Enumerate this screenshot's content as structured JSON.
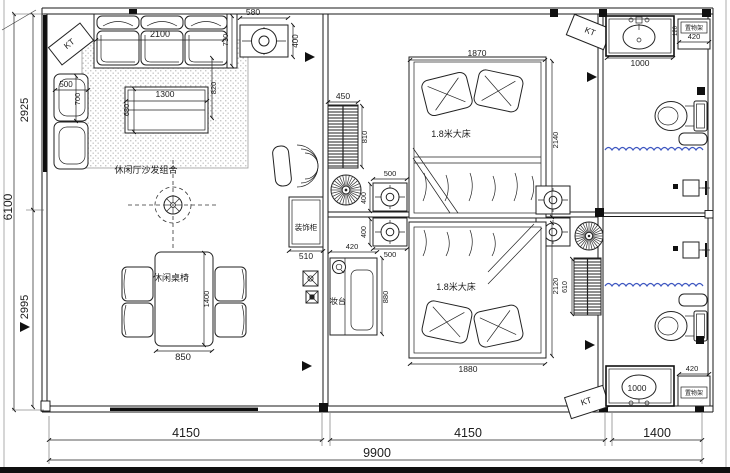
{
  "drawing": {
    "type": "residential floor plan",
    "overall_width_mm": "9900",
    "overall_height_mm": "6100",
    "room_labels": {
      "living_sofa_set": "休闲厅沙发组合",
      "leisure_table_chairs": "休闲桌椅",
      "decorative_cabinet": "装饰柜",
      "dressing_table": "妆台",
      "double_bed": "1.8米大床",
      "shelf_rack": "置物架",
      "air_conditioner": "KT"
    },
    "fixtures": [
      "ceiling-fan",
      "air-conditioner-unit",
      "ac-cassette",
      "radiator-grille",
      "bed",
      "sofa",
      "armchair",
      "coffee-table",
      "dining-table",
      "dining-chair",
      "desk-chair",
      "dressing-table",
      "decorative-cabinet",
      "vanity-sink",
      "toilet",
      "bath-mat",
      "shelf-rack",
      "shower-head",
      "shower-curtain",
      "wall-switch",
      "hairdryer"
    ]
  },
  "colors": {
    "line": "#1a1a1a",
    "water": "#3d56c0",
    "background": "#ffffff"
  },
  "labels": [
    {
      "text": "580",
      "x": 253,
      "y": 15,
      "rot": 0,
      "size": 8.5
    },
    {
      "text": "400",
      "x": 298,
      "y": 41,
      "rot": -90,
      "size": 8
    },
    {
      "text": "2100",
      "x": 160,
      "y": 37,
      "rot": 0,
      "size": 9
    },
    {
      "text": "730",
      "x": 228,
      "y": 40,
      "rot": -90,
      "size": 7.5
    },
    {
      "text": "820",
      "x": 216,
      "y": 88,
      "rot": -90,
      "size": 7.5
    },
    {
      "text": "KT",
      "x": 71,
      "y": 46,
      "rot": -38,
      "size": 8.5
    },
    {
      "text": "500",
      "x": 66,
      "y": 87,
      "rot": 0,
      "size": 8
    },
    {
      "text": "700",
      "x": 80,
      "y": 99,
      "rot": -90,
      "size": 7.5
    },
    {
      "text": "1300",
      "x": 165,
      "y": 97,
      "rot": 0,
      "size": 8.5
    },
    {
      "text": "680",
      "x": 129,
      "y": 110,
      "rot": -90,
      "size": 7.5
    },
    {
      "text": "休闲厅沙发组合",
      "x": 146,
      "y": 173,
      "rot": 0,
      "size": 9
    },
    {
      "text": "休闲桌椅",
      "x": 171,
      "y": 281,
      "rot": 0,
      "size": 9
    },
    {
      "text": "1400",
      "x": 209,
      "y": 299,
      "rot": -90,
      "size": 7.5
    },
    {
      "text": "850",
      "x": 183,
      "y": 360,
      "rot": 0,
      "size": 9.5
    },
    {
      "text": "装饰柜",
      "x": 306,
      "y": 230,
      "rot": 0,
      "size": 7.5
    },
    {
      "text": "510",
      "x": 306,
      "y": 259,
      "rot": 0,
      "size": 8.5
    },
    {
      "text": "2925",
      "x": 28,
      "y": 110,
      "rot": -90,
      "size": 11
    },
    {
      "text": "6100",
      "x": 12,
      "y": 207,
      "rot": -90,
      "size": 12
    },
    {
      "text": "2995",
      "x": 28,
      "y": 307,
      "rot": -90,
      "size": 11
    },
    {
      "text": "450",
      "x": 343,
      "y": 99,
      "rot": 0,
      "size": 8.5
    },
    {
      "text": "810",
      "x": 367,
      "y": 137,
      "rot": -90,
      "size": 7.5
    },
    {
      "text": "1870",
      "x": 477,
      "y": 56,
      "rot": 0,
      "size": 8.5
    },
    {
      "text": "1.8米大床",
      "x": 451,
      "y": 137,
      "rot": 0,
      "size": 9
    },
    {
      "text": "2140",
      "x": 558,
      "y": 140,
      "rot": -90,
      "size": 7.5
    },
    {
      "text": "500",
      "x": 390,
      "y": 176,
      "rot": 0,
      "size": 7.5
    },
    {
      "text": "400",
      "x": 366,
      "y": 198,
      "rot": -90,
      "size": 7
    },
    {
      "text": "500",
      "x": 390,
      "y": 257,
      "rot": 0,
      "size": 7.5
    },
    {
      "text": "400",
      "x": 366,
      "y": 232,
      "rot": -90,
      "size": 7
    },
    {
      "text": "KT",
      "x": 589,
      "y": 34,
      "rot": 22,
      "size": 8.5
    },
    {
      "text": "420",
      "x": 352,
      "y": 249,
      "rot": 0,
      "size": 7.5
    },
    {
      "text": "妆台",
      "x": 338,
      "y": 304,
      "rot": 0,
      "size": 8
    },
    {
      "text": "880",
      "x": 388,
      "y": 297,
      "rot": -90,
      "size": 7.5
    },
    {
      "text": "1.8米大床",
      "x": 456,
      "y": 290,
      "rot": 0,
      "size": 9
    },
    {
      "text": "1880",
      "x": 468,
      "y": 372,
      "rot": 0,
      "size": 8.5
    },
    {
      "text": "2120",
      "x": 558,
      "y": 286,
      "rot": -90,
      "size": 7.5
    },
    {
      "text": "610",
      "x": 567,
      "y": 287,
      "rot": -90,
      "size": 7
    },
    {
      "text": "KT",
      "x": 587,
      "y": 404,
      "rot": -18,
      "size": 8.5
    },
    {
      "text": "1000",
      "x": 640,
      "y": 66,
      "rot": 0,
      "size": 8.5
    },
    {
      "text": "置物架",
      "x": 694,
      "y": 30,
      "rot": 0,
      "size": 6
    },
    {
      "text": "420",
      "x": 694,
      "y": 39,
      "rot": 0,
      "size": 7.5
    },
    {
      "text": "120",
      "x": 677,
      "y": 31,
      "rot": -90,
      "size": 6
    },
    {
      "text": "420",
      "x": 692,
      "y": 371,
      "rot": 0,
      "size": 7.5
    },
    {
      "text": "1000",
      "x": 637,
      "y": 391,
      "rot": 0,
      "size": 8.5
    },
    {
      "text": "置物架",
      "x": 694,
      "y": 395,
      "rot": 0,
      "size": 6
    },
    {
      "text": "4150",
      "x": 186,
      "y": 437,
      "rot": 0,
      "size": 12.5
    },
    {
      "text": "4150",
      "x": 468,
      "y": 437,
      "rot": 0,
      "size": 12.5
    },
    {
      "text": "1400",
      "x": 657,
      "y": 437,
      "rot": 0,
      "size": 12.5
    },
    {
      "text": "9900",
      "x": 377,
      "y": 457,
      "rot": 0,
      "size": 12.5
    }
  ]
}
